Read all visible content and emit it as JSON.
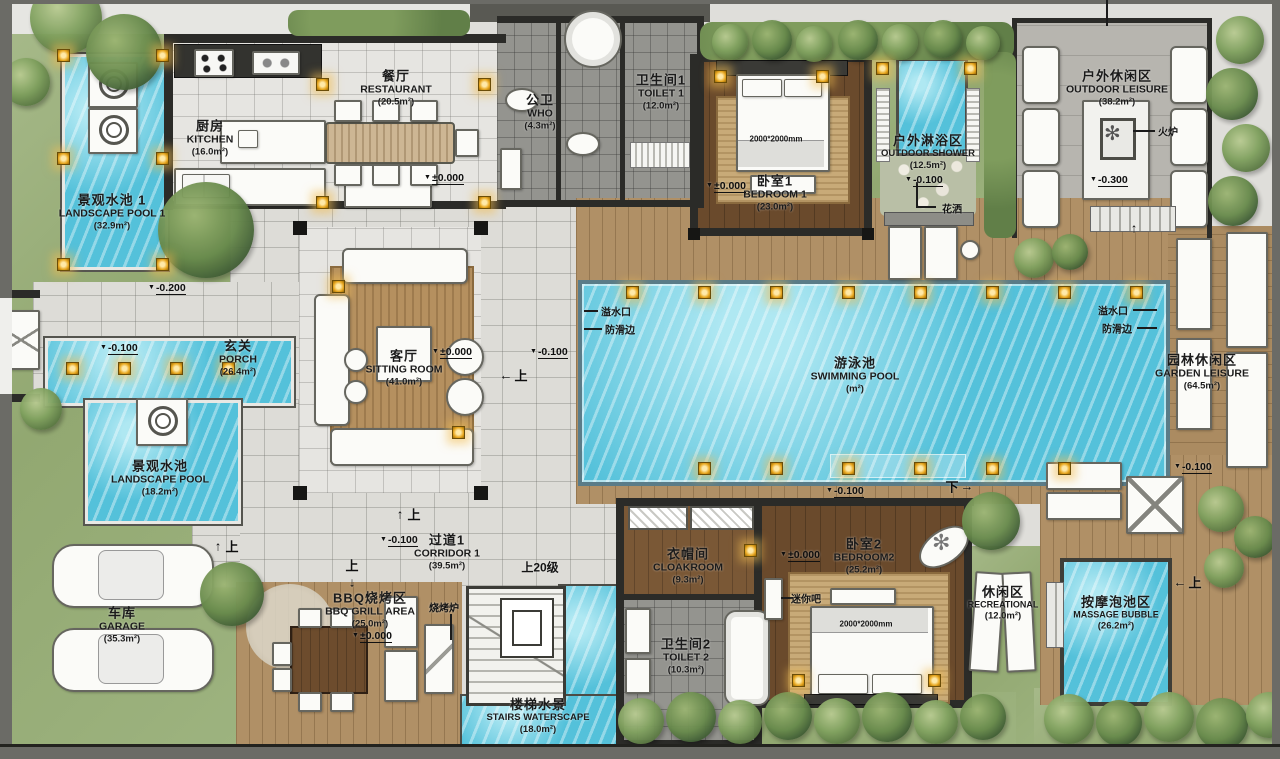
{
  "palette": {
    "water": "#54c1da",
    "grass": "#9cb07e",
    "deck": "#b09066",
    "wood_dark": "#6a4a2c",
    "gold": "#e7a61e",
    "wall": "#2b2b28",
    "tile": "#dddcd7",
    "dark_tile": "#94948f"
  },
  "rooms": {
    "landscape_pool_1": {
      "zh": "景观水池 1",
      "en": "LANDSCAPE POOL 1",
      "area": "(32.9m²)"
    },
    "kitchen": {
      "zh": "厨房",
      "en": "KITCHEN",
      "area": "(16.0m²)"
    },
    "restaurant": {
      "zh": "餐厅",
      "en": "RESTAURANT",
      "area": "(20.5m²)"
    },
    "who": {
      "zh": "公卫",
      "en": "WHO",
      "area": "(4.3m²)"
    },
    "toilet1": {
      "zh": "卫生间1",
      "en": "TOILET 1",
      "area": "(12.0m²)"
    },
    "bedroom1": {
      "zh": "卧室1",
      "en": "BEDROOM 1",
      "area": "(23.0m²)"
    },
    "outdoor_shower": {
      "zh": "户外淋浴区",
      "en": "OUTDOOR SHOWER",
      "area": "(12.5m²)"
    },
    "outdoor_leisure": {
      "zh": "户外休闲区",
      "en": "OUTDOOR LEISURE",
      "area": "(38.2m²)"
    },
    "porch": {
      "zh": "玄关",
      "en": "PORCH",
      "area": "(26.4m²)"
    },
    "sitting_room": {
      "zh": "客厅",
      "en": "SITTING ROOM",
      "area": "(41.0m²)"
    },
    "swimming_pool": {
      "zh": "游泳池",
      "en": "SWIMMING POOL",
      "area": "(m²)"
    },
    "garden_leisure": {
      "zh": "园林休闲区",
      "en": "GARDEN LEISURE",
      "area": "(64.5m²)"
    },
    "landscape_pool": {
      "zh": "景观水池",
      "en": "LANDSCAPE POOL",
      "area": "(18.2m²)"
    },
    "garage": {
      "zh": "车库",
      "en": "GARAGE",
      "area": "(35.3m²)"
    },
    "corridor1": {
      "zh": "过道1",
      "en": "CORRIDOR 1",
      "area": "(39.5m²)"
    },
    "bbq": {
      "zh": "BBQ烧烤区",
      "en": "BBQ GRILL AREA",
      "area": "(25.0m²)"
    },
    "stairs_waterscape": {
      "zh": "楼梯水景",
      "en": "STAIRS WATERSCAPE",
      "area": "(18.0m²)"
    },
    "cloakroom": {
      "zh": "衣帽间",
      "en": "CLOAKROOM",
      "area": "(9.3m²)"
    },
    "toilet2": {
      "zh": "卫生间2",
      "en": "TOILET 2",
      "area": "(10.3m²)"
    },
    "bedroom2": {
      "zh": "卧室2",
      "en": "BEDROOM2",
      "area": "(25.2m²)"
    },
    "recreational": {
      "zh": "休闲区",
      "en": "RECREATIONAL",
      "area": "(12.0m²)"
    },
    "massage": {
      "zh": "按摩泡池区",
      "en": "MASSAGE BUBBLE",
      "area": "(26.2m²)"
    }
  },
  "elevations": {
    "zero": "±0.000",
    "m100": "-0.100",
    "m200": "-0.200",
    "m300": "-0.300"
  },
  "annotations": {
    "fire_stove": "火炉",
    "shower_head": "花洒",
    "grill": "烧烤炉",
    "minibar": "迷你吧",
    "overflow": "溢水口",
    "antislip": "防滑边",
    "steps20": "上20级",
    "up": "上",
    "down": "下",
    "bed_size": "2000*2000mm",
    "arrow_up": "↑",
    "arrow_down": "↓",
    "arrow_left": "←",
    "arrow_right": "→"
  },
  "icons": {
    "level_triangle": "▼",
    "fan": "✻"
  }
}
